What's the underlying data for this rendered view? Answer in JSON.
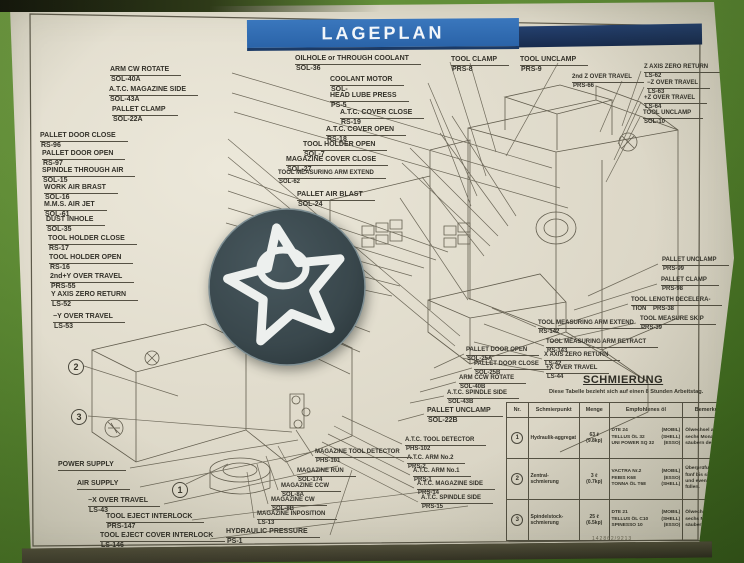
{
  "title": "LAGEPLAN",
  "markers": [
    "1",
    "2",
    "3"
  ],
  "callouts": [
    {
      "text": "ARM CW ROTATE",
      "sub": "SOL-40A"
    },
    {
      "text": "A.T.C. MAGAZINE SIDE",
      "sub": "SOL-43A"
    },
    {
      "text": "PALLET CLAMP",
      "sub": "SOL-22A"
    },
    {
      "text": "PALLET DOOR CLOSE",
      "sub": "RS-96"
    },
    {
      "text": "PALLET DOOR OPEN",
      "sub": "RS-97"
    },
    {
      "text": "SPINDLE THROUGH AIR",
      "sub": "SOL-15"
    },
    {
      "text": "WORK AIR BRAST",
      "sub": "SOL-16"
    },
    {
      "text": "M.M.S. AIR JET",
      "sub": "SOL-61"
    },
    {
      "text": "DUST INHOLE",
      "sub": "SOL-35"
    },
    {
      "text": "TOOL HOLDER CLOSE",
      "sub": "RS-17"
    },
    {
      "text": "TOOL HOLDER OPEN",
      "sub": "RS-16"
    },
    {
      "text": "2nd+Y OVER TRAVEL",
      "sub": "PRS-55"
    },
    {
      "text": "Y AXIS ZERO RETURN",
      "sub": "LS-52"
    },
    {
      "text": "−Y OVER TRAVEL",
      "sub": "LS-53"
    },
    {
      "text": "OILHOLE or THROUGH COOLANT",
      "sub": "SOL-36"
    },
    {
      "text": "COOLANT MOTOR",
      "sub": "SOL-"
    },
    {
      "text": "HEAD LUBE PRESS",
      "sub": "PS-5"
    },
    {
      "text": "A.T.C. COVER CLOSE",
      "sub": "RS-19"
    },
    {
      "text": "A.T.C. COVER OPEN",
      "sub": "RS-18"
    },
    {
      "text": "TOOL HOLDER OPEN",
      "sub": "SOL-7"
    },
    {
      "text": "MAGAZINE COVER CLOSE",
      "sub": "SOL-27"
    },
    {
      "text": "TOOL MEASURING ARM EXTEND",
      "sub": "SOL-62"
    },
    {
      "text": "PALLET AIR BLAST",
      "sub": "SOL-24"
    },
    {
      "text": "TOOL CLAMP",
      "sub": "PRS-8"
    },
    {
      "text": "TOOL UNCLAMP",
      "sub": "PRS-9"
    },
    {
      "text": "2nd Z OVER TRAVEL",
      "sub": "PRS-66"
    },
    {
      "text": "Z AXIS ZERO RETURN",
      "sub": "LS-62"
    },
    {
      "text": "−Z OVER TRAVEL",
      "sub": "LS-63"
    },
    {
      "text": "+Z OVER TRAVEL",
      "sub": "LS-64"
    },
    {
      "text": "TOOL UNCLAMP",
      "sub": "SOL-10"
    },
    {
      "text": "PALLET UNCLAMP",
      "sub": "PRS-99"
    },
    {
      "text": "PALLET CLAMP",
      "sub": "PRS-98"
    },
    {
      "text": "TOOL LENGTH DECELERA-",
      "sub": "TION    PRS-38"
    },
    {
      "text": "TOOL MEASURE SKIP",
      "sub": "PRS-39"
    },
    {
      "text": "TOOL MEASURING ARM EXTEND",
      "sub": "RS-142"
    },
    {
      "text": "TOOL MEASURING ARM RETRACT",
      "sub": "RS-143"
    },
    {
      "text": "X AXIS ZERO RETURN",
      "sub": "LS-42"
    },
    {
      "text": "+X OVER TRAVEL",
      "sub": "LS-44"
    },
    {
      "text": "PALLET DOOR OPEN",
      "sub": "SOL-25A"
    },
    {
      "text": "PALLET DOOR CLOSE",
      "sub": "SOL-25B"
    },
    {
      "text": "ARM CCW ROTATE",
      "sub": "SOL-40B"
    },
    {
      "text": "A.T.C. SPINDLE SIDE",
      "sub": "SOL-43B"
    },
    {
      "text": "PALLET UNCLAMP",
      "sub": "SOL-22B"
    },
    {
      "text": "A.T.C. TOOL DETECTOR",
      "sub": "PHS-102"
    },
    {
      "text": "A.T.C. ARM No.2",
      "sub": "PRS-2"
    },
    {
      "text": "A.T.C. ARM No.1",
      "sub": "PRS-1"
    },
    {
      "text": "A.T.C. MAGAZINE SIDE",
      "sub": "PRS-14"
    },
    {
      "text": "A.T.C. SPINDLE SIDE",
      "sub": "PRS-15"
    },
    {
      "text": "MAGAZINE TOOL DETECTOR",
      "sub": "PHS-101"
    },
    {
      "text": "MAGAZINE RUN",
      "sub": "SOL-174"
    },
    {
      "text": "MAGAZINE CCW",
      "sub": "SOL-8A"
    },
    {
      "text": "MAGAZINE CW",
      "sub": "SOL-8B"
    },
    {
      "text": "MAGAZINE INPOSITION",
      "sub": "LS-13"
    },
    {
      "text": "HYDRAULIC PRESSURE",
      "sub": "PS-1"
    },
    {
      "text": "POWER SUPPLY",
      "sub": ""
    },
    {
      "text": "AIR SUPPLY",
      "sub": ""
    },
    {
      "text": "−X OVER TRAVEL",
      "sub": "LS-43"
    },
    {
      "text": "TOOL EJECT INTERLOCK",
      "sub": "PRS-147"
    },
    {
      "text": "TOOL EJECT COVER INTERLOCK",
      "sub": "LS-146"
    }
  ],
  "schmierung": {
    "heading": "SCHMIERUNG",
    "note": "Diese Tabelle bezieht sich auf einen 8 Stunden Arbeitstag.",
    "headers": [
      "Nr.",
      "Schmierpunkt",
      "Menge",
      "Empfohlenes öl",
      "Bemerkung"
    ],
    "rows": [
      {
        "nr": "1",
        "punkt": "Hydraulik-aggregat",
        "menge1": "63 ℓ",
        "menge2": "(9.8kp)",
        "oils": [
          [
            "DTE 24",
            "(MOBIL)"
          ],
          [
            "TELLUS ÖL 32",
            "(SHELL)"
          ],
          [
            "UNI POWER SQ 32",
            "(ESSO)"
          ]
        ],
        "bemerkung": "Ölwechsel alle sechs Monate und säubern des Filters."
      },
      {
        "nr": "2",
        "punkt": "Zentral-schmierung",
        "menge1": "3 ℓ",
        "menge2": "(0.7kp)",
        "oils": [
          [
            "VACTRA Nr.2",
            "(MOBIL)"
          ],
          [
            "FEBIS K68",
            "(ESSO)"
          ],
          [
            "TONNA ÖL T68",
            "(SHELL)"
          ]
        ],
        "bemerkung": "Überprüfung alle fünf bis sieben Tage und eventl. nach füllen."
      },
      {
        "nr": "3",
        "punkt": "Spindelstock-schmierung",
        "menge1": "25 ℓ",
        "menge2": "(6.5kp)",
        "oils": [
          [
            "DTE 21",
            "(MOBIL)"
          ],
          [
            "TELLUS ÖL C10",
            "(SHELL)"
          ],
          [
            "SPINESSO 10",
            "(ESSO)"
          ]
        ],
        "bemerkung": "Ölwechsel alle sechs Monate und säubern des Filters."
      }
    ]
  },
  "footer": {
    "code": "142862/9213"
  }
}
